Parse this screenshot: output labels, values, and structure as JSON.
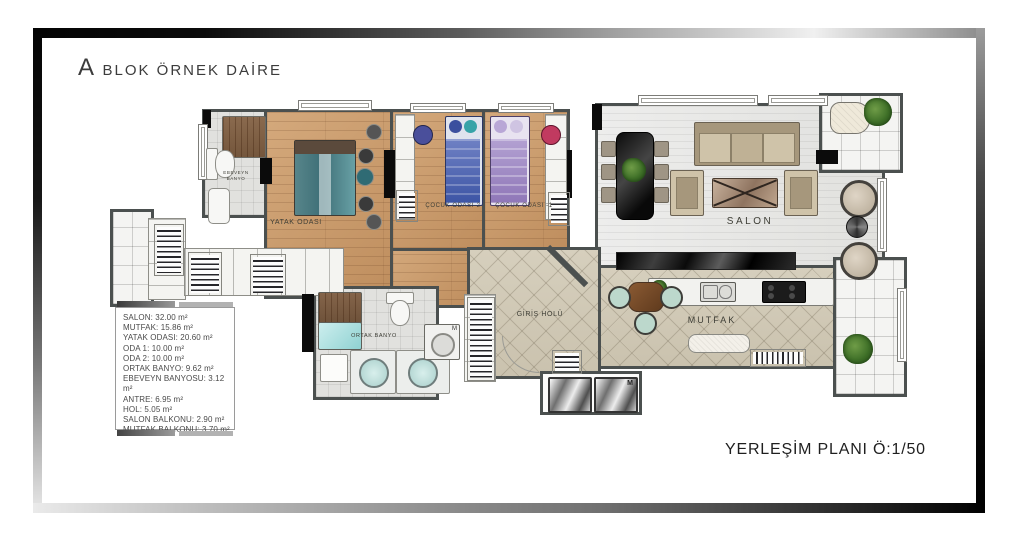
{
  "page": {
    "title_initial": "A",
    "title_rest": "BLOK ÖRNEK DAİRE",
    "scale_note": "YERLEŞİM PLANI Ö:1/50"
  },
  "legend": {
    "items": [
      "SALON: 32.00 m²",
      "MUTFAK: 15.86 m²",
      "YATAK ODASI: 20.60 m²",
      "ODA 1: 10.00 m²",
      "ODA 2: 10.00 m²",
      "ORTAK BANYO: 9.62 m²",
      "EBEVEYN BANYOSU: 3.12 m²",
      "ANTRE: 6.95 m²",
      "HOL: 5.05 m²",
      "SALON BALKONU: 2.90 m²",
      "MUTFAK BALKONU: 3.70 m²"
    ]
  },
  "rooms": {
    "yatak_odasi": "YATAK ODASI",
    "cocuk_odasi_2": "ÇOCUK ODASI-2",
    "cocuk_odasi_1": "ÇOCUK ODASI -1",
    "salon": "SALON",
    "mutfak": "MUTFAK",
    "giris_holu": "GİRİŞ HOLÜ",
    "ortak_banyo": "ORTAK BANYO",
    "ebeveyn_banyo": "EBEVEYN BANYO"
  },
  "symbols": {
    "washer": "M",
    "elevator": "M"
  }
}
